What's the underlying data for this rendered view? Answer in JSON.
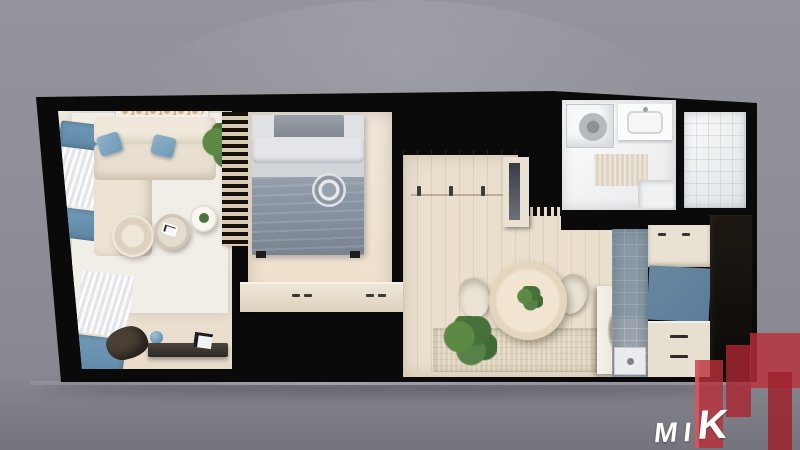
{
  "scene": {
    "type": "3d-apartment-floor-plan-top-view",
    "visible_text": "MIK"
  },
  "logo": {
    "text": "MIK",
    "letters": [
      "M",
      "I",
      "K"
    ]
  },
  "palette": {
    "backdrop_top": "#94949d",
    "backdrop_bottom": "#74747d",
    "wall": "#0a0a0b",
    "wood_floor": "#eadfcd",
    "rug_white": "#f1eee8",
    "rug_beige": "#ddd1ba",
    "accent_blue": "#6f99b6",
    "bed_gray": "#8a95a3",
    "kitchen_tile": "#9aa3ab",
    "cabinet_cream": "#e9e1d2",
    "cabinet_blue": "#5b7d9c",
    "bath_white": "#f3f4f5",
    "plant_green": "#4c7339",
    "brand_red": "#c5293a",
    "logo_text_color": "#ffffff"
  },
  "rooms": [
    {
      "id": "living-room",
      "furniture": [
        "corner-sofa",
        "blue-pillows",
        "round-pouf",
        "coffee-tables",
        "tv-console",
        "driftwood-decor",
        "blue-ball",
        "curtained-windows",
        "corner-plant",
        "wall-shelf",
        "slat-divider"
      ]
    },
    {
      "id": "bedroom",
      "furniture": [
        "double-bed",
        "headboard",
        "pillows",
        "gray-duvet",
        "round-pillow",
        "dresser"
      ]
    },
    {
      "id": "hallway-dining",
      "furniture": [
        "coat-hooks",
        "mirror-cabinet",
        "radiator",
        "round-dining-table",
        "two-chairs",
        "table-plant",
        "floor-plant",
        "woven-rug",
        "open-door"
      ]
    },
    {
      "id": "kitchen-utility",
      "furniture": [
        "upper-cabinets",
        "blue-cabinet-panel",
        "drawer-unit",
        "shower-tray",
        "tall-dark-units",
        "gray-tile-floor"
      ]
    },
    {
      "id": "bathroom",
      "furniture": [
        "shower-cabin",
        "washer-drum",
        "sink-vanity",
        "bath-mat",
        "toilet"
      ]
    },
    {
      "id": "side-tiled-room",
      "furniture": [
        "empty-tiled-floor"
      ]
    }
  ]
}
